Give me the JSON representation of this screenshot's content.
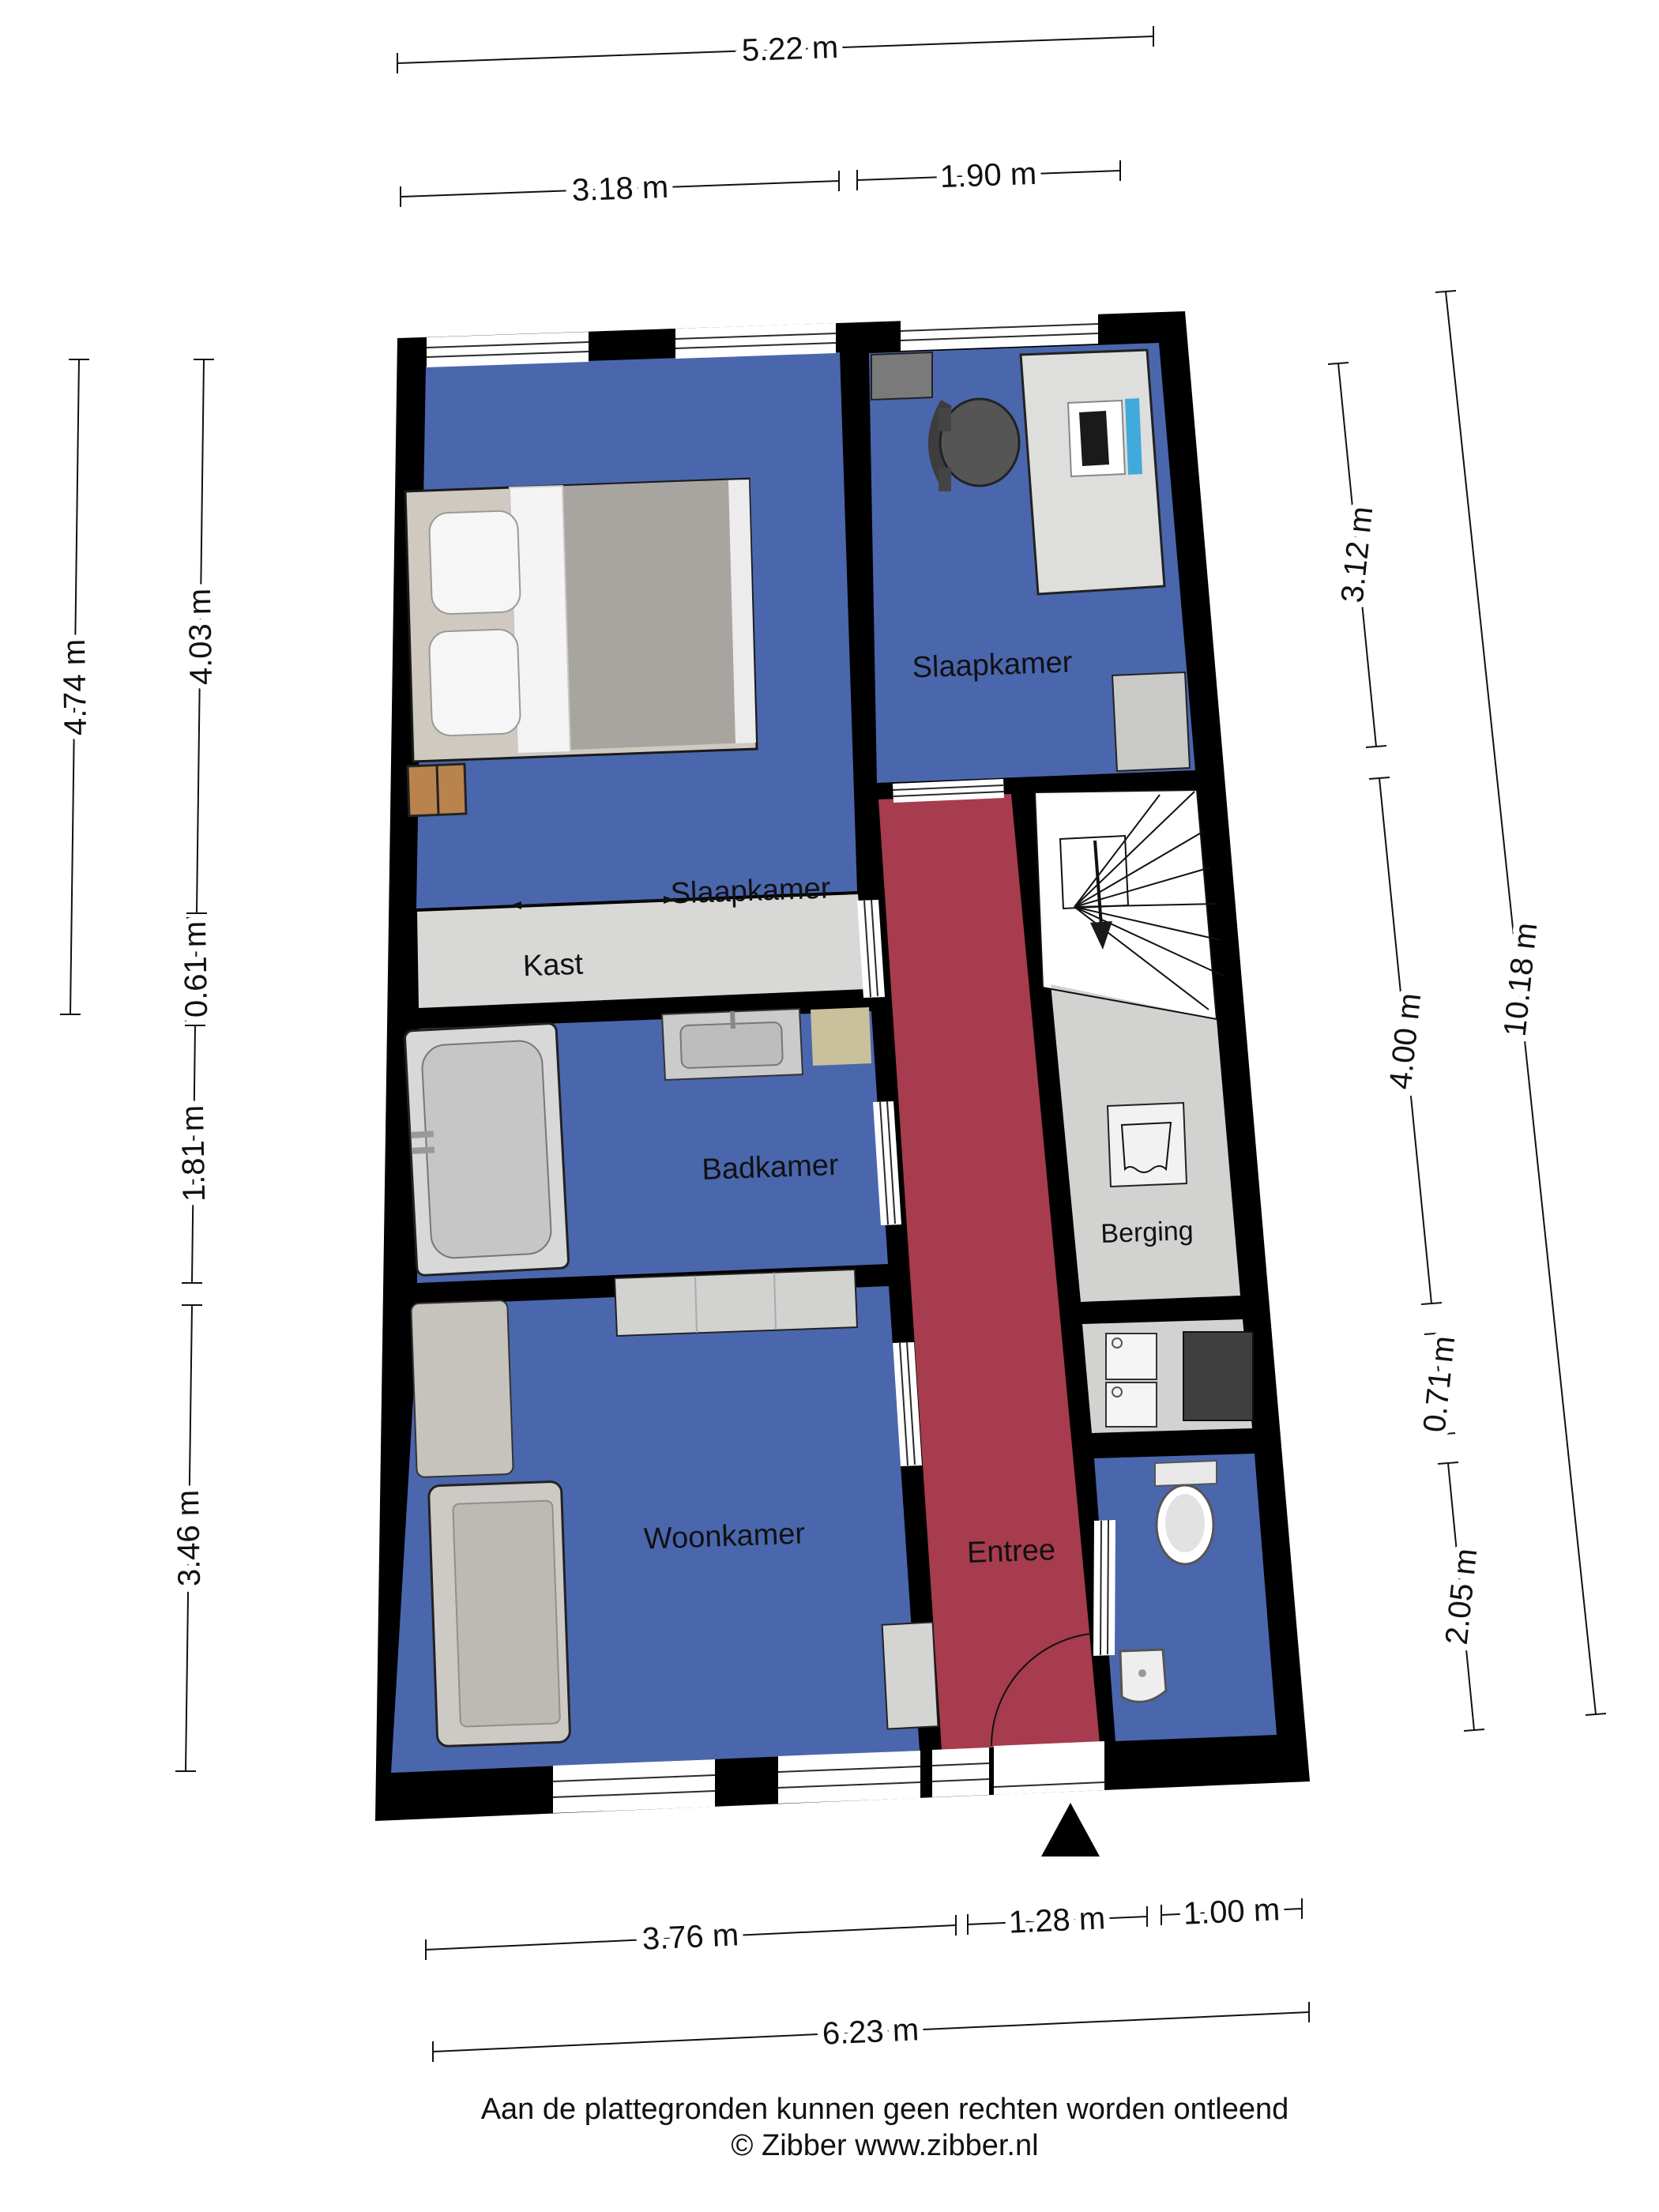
{
  "rooms": {
    "slaapkamer1": "Slaapkamer",
    "slaapkamer2": "Slaapkamer",
    "kast": "Kast",
    "badkamer": "Badkamer",
    "woonkamer": "Woonkamer",
    "entree": "Entree",
    "berging": "Berging"
  },
  "dimensions": {
    "top_total": "5.22 m",
    "top_left": "3.18 m",
    "top_right": "1.90 m",
    "left_total": "4.74 m",
    "left_bedroom": "4.03 m",
    "left_closet": "0.61 m",
    "left_bathroom": "1.81 m",
    "left_living": "3.46 m",
    "right_bedroom": "3.12 m",
    "right_stairs": "4.00 m",
    "right_storage": "0.71 m",
    "right_toilet": "2.05 m",
    "right_total": "10.18 m",
    "bottom_living": "3.76 m",
    "bottom_entry": "1.28 m",
    "bottom_toilet": "1.00 m",
    "bottom_total": "6.23 m"
  },
  "footer": {
    "disclaimer": "Aan de plattegronden kunnen geen rechten worden ontleend",
    "copyright": "© Zibber www.zibber.nl"
  },
  "colors": {
    "wall": "#000000",
    "room": "#4a67ae",
    "entree": "#a63c4d",
    "closet_floor": "#d8d8d6",
    "storage_floor": "#d2d2d0",
    "stairs_floor": "#ffffff",
    "mat": "#c9c09c",
    "laptop": "#41aadc"
  }
}
